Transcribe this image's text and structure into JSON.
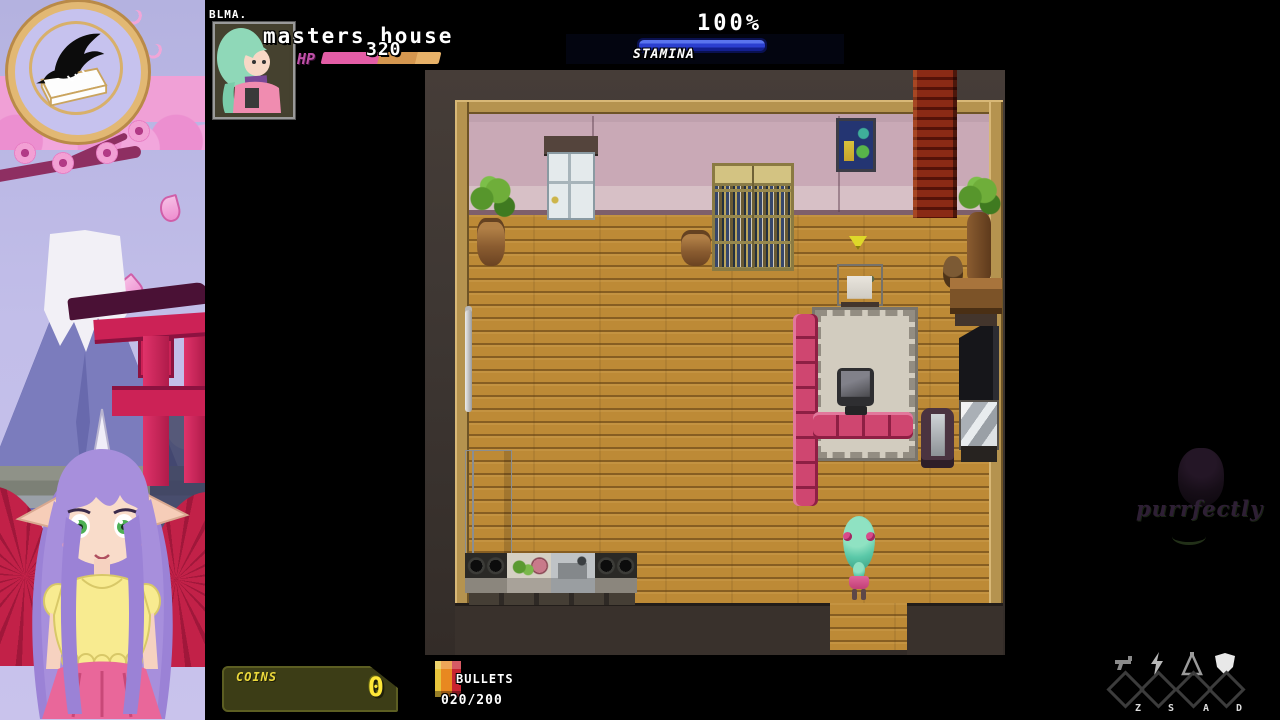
{
  "overlay": {
    "logo_icon": "crow-on-book-logo",
    "watermark": "purrfectly",
    "theme_colors": {
      "sakura_pink": "#f2a0d4",
      "sky_lavender": "#bdbae6",
      "torii_red": "#cc2256",
      "frame_gold": "#e2b873"
    }
  },
  "hud": {
    "area_tag": "BLMA.",
    "location_name": "masters house",
    "portrait_icon": "green-haired-girl-portrait",
    "hp": {
      "label": "HP",
      "value": "320",
      "bar_color": "#e35da6"
    },
    "stamina": {
      "label": "STAMINA",
      "value": "100%",
      "bar_color": "#2b3fd0",
      "percent": 100
    },
    "coins": {
      "label": "COINS",
      "value": "0",
      "text_color": "#ffe838"
    },
    "bullets": {
      "label": "BULLETS",
      "value": "020/200",
      "icon": "bullet-box-icon"
    },
    "skills": [
      {
        "key": "Z",
        "icon": "pistol-icon"
      },
      {
        "key": "S",
        "icon": "lightning-icon"
      },
      {
        "key": "A",
        "icon": "flask-icon"
      },
      {
        "key": "D",
        "icon": "shield-icon"
      }
    ]
  }
}
